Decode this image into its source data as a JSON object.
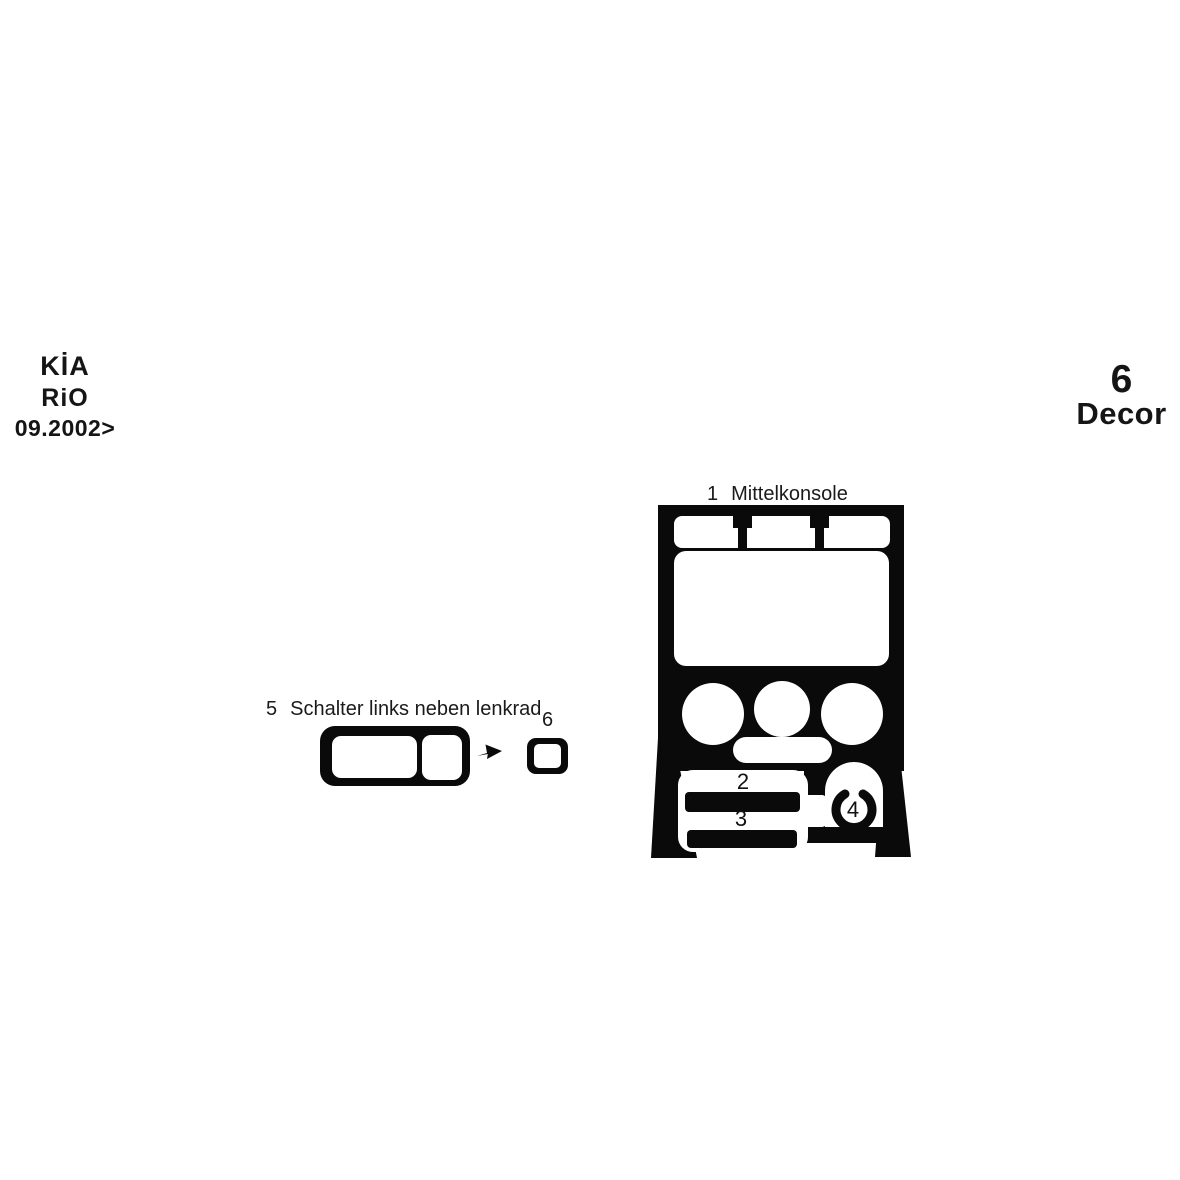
{
  "colors": {
    "ink": "#0a0a0a",
    "background": "#ffffff",
    "label_text": "#1a1a1a"
  },
  "vehicle": {
    "make": "KİA",
    "model": "RiO",
    "year_from": "09.2002>"
  },
  "kit": {
    "piece_count": "6",
    "label": "Decor"
  },
  "parts": {
    "p1": {
      "number": "1",
      "label": "Mittelkonsole"
    },
    "p2": {
      "number": "2"
    },
    "p3": {
      "number": "3"
    },
    "p4": {
      "number": "4"
    },
    "p5": {
      "number": "5",
      "label": "Schalter links neben lenkrad"
    },
    "p6": {
      "number": "6"
    }
  }
}
